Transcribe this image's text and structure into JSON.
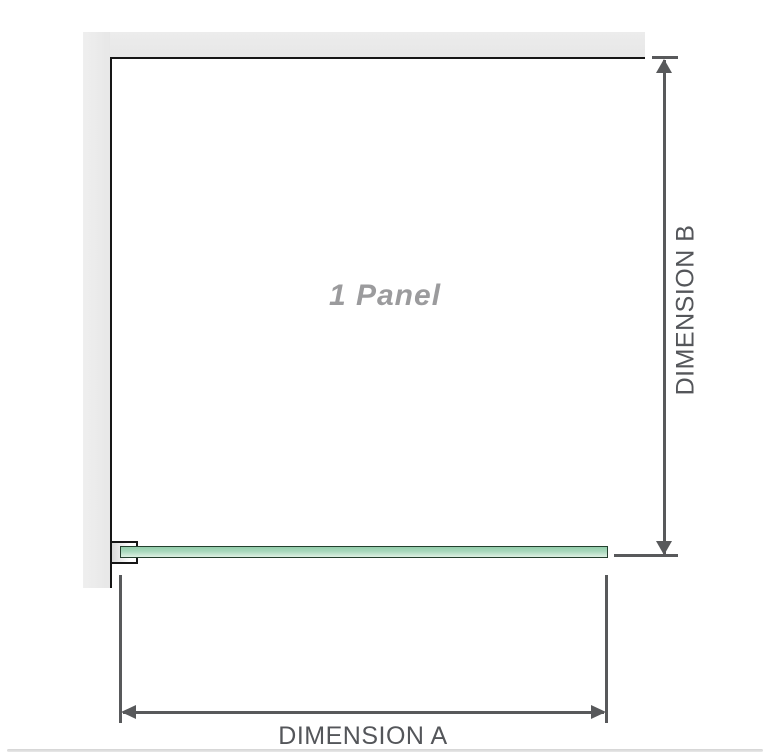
{
  "diagram": {
    "panel_label": "1 Panel",
    "dimension_a_label": "DIMENSION A",
    "dimension_b_label": "DIMENSION B"
  },
  "icons": {
    "dimension_b_arrows": "double-headed-vertical-arrow",
    "dimension_a_arrows": "double-headed-horizontal-arrow"
  },
  "colors": {
    "wall_fill": "#e9e9e9",
    "panel_outline": "#161616",
    "dimension_lines": "#58595b",
    "dimension_text": "#54565a",
    "panel_label_text": "#9b9b9d",
    "glass_border": "#24402e",
    "glass_fill_top": "#93cdab",
    "glass_fill_bottom": "#def0e4",
    "base_rule": "#d4d4d4"
  }
}
